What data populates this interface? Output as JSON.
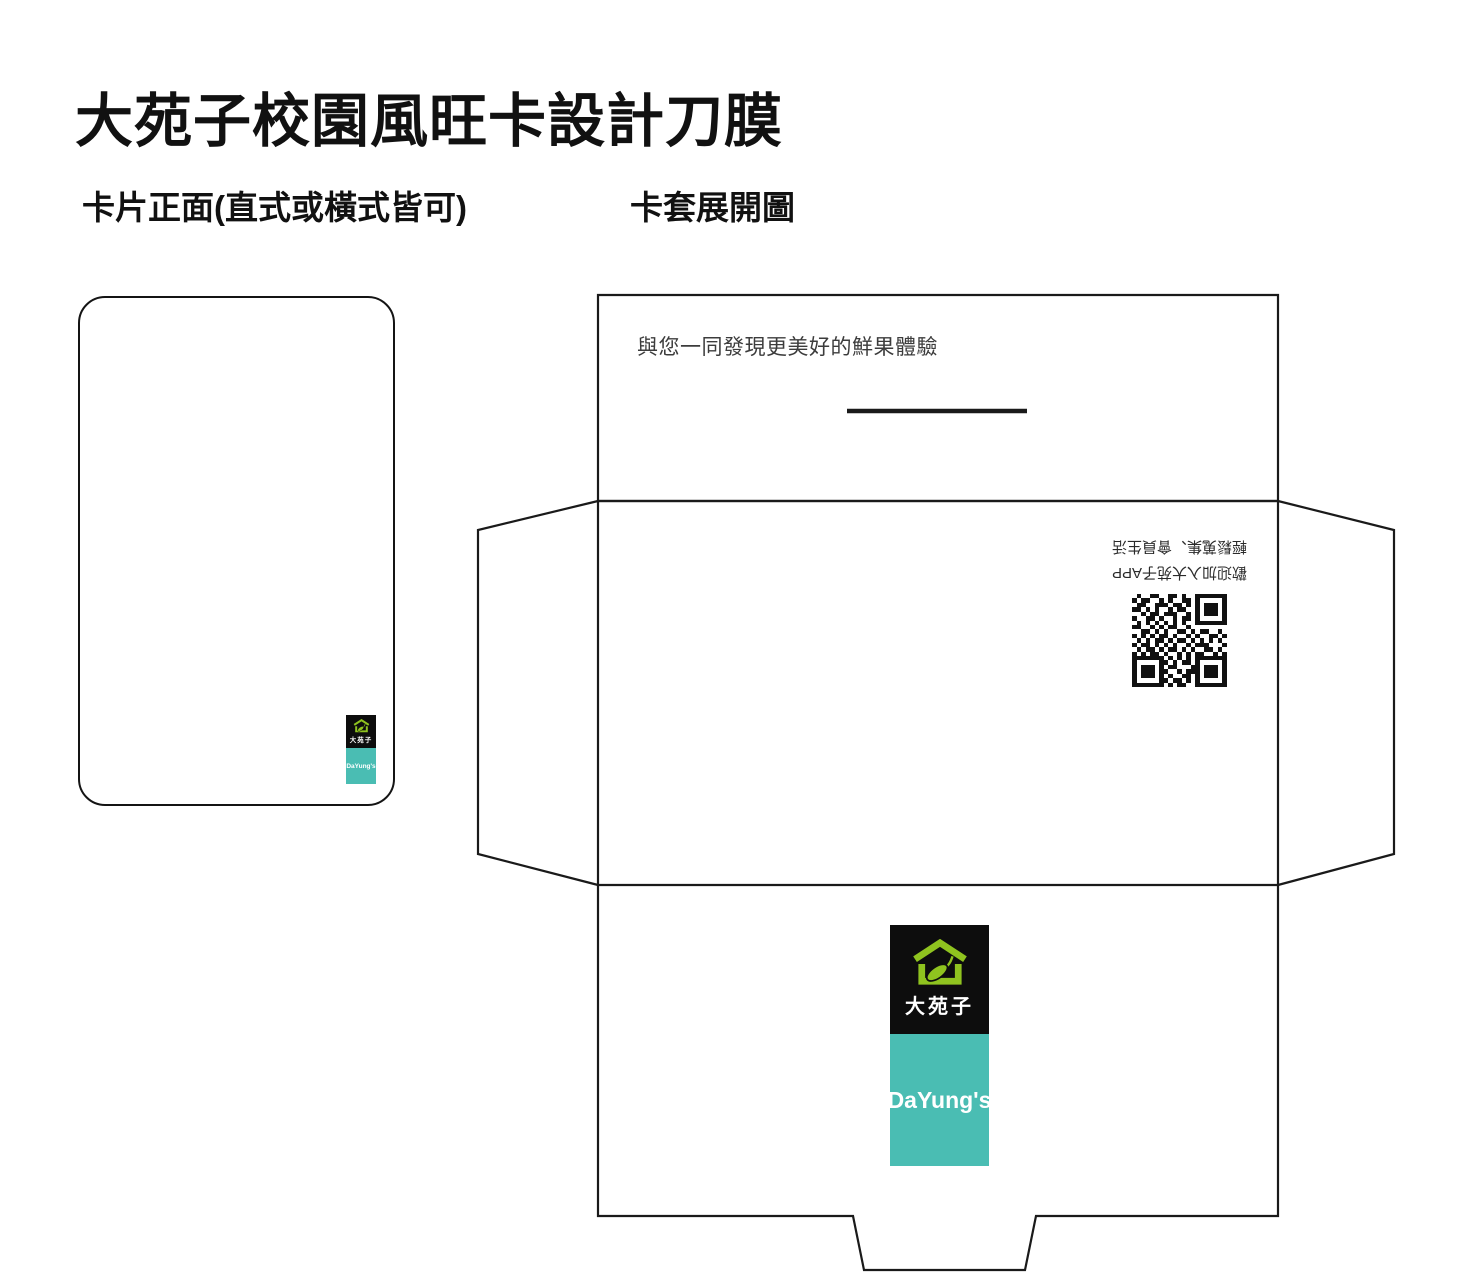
{
  "page": {
    "title": "大苑子校園風旺卡設計刀膜"
  },
  "sections": {
    "card_front_label": "卡片正面(直式或橫式皆可)",
    "sleeve_label": "卡套展開圖"
  },
  "logo": {
    "name_zh": "大苑子",
    "name_en": "DaYung's",
    "icon": "house-with-leaf-icon",
    "colors": {
      "green": "#8fc31f",
      "teal": "#4abdb3",
      "black": "#0d0d0d",
      "text": "#ffffff"
    }
  },
  "sleeve": {
    "front_tagline": "與您一同發現更美好的鮮果體驗",
    "rotated_note": {
      "rotation_deg": 180,
      "line1": "歡迎加入大苑子APP",
      "line2": "輕鬆蒐集、會員生活"
    },
    "qr": {
      "name": "app-qr-code",
      "rotated": true,
      "matrix": [
        "010011001101001111111",
        "101100101001101000001",
        "011001110110101011101",
        "110101001011001011101",
        "001011011100101011101",
        "100110100101101000001",
        "010101010101001111111",
        "110010101100100000000",
        "001101010011010110010",
        "101010110100101001101",
        "010101101011010101010",
        "101101010100101110001",
        "010110101101010011010",
        "101011010010101100101",
        "111111101010101111111",
        "100000110101101000001",
        "101110101100011011101",
        "101110110010111011101",
        "101110101001101011101",
        "100000110110101000001",
        "111111101011001111111"
      ]
    }
  },
  "colors": {
    "background": "#ffffff",
    "dieline": "#1a1a1a",
    "tagline_text": "#3c3c3c"
  }
}
